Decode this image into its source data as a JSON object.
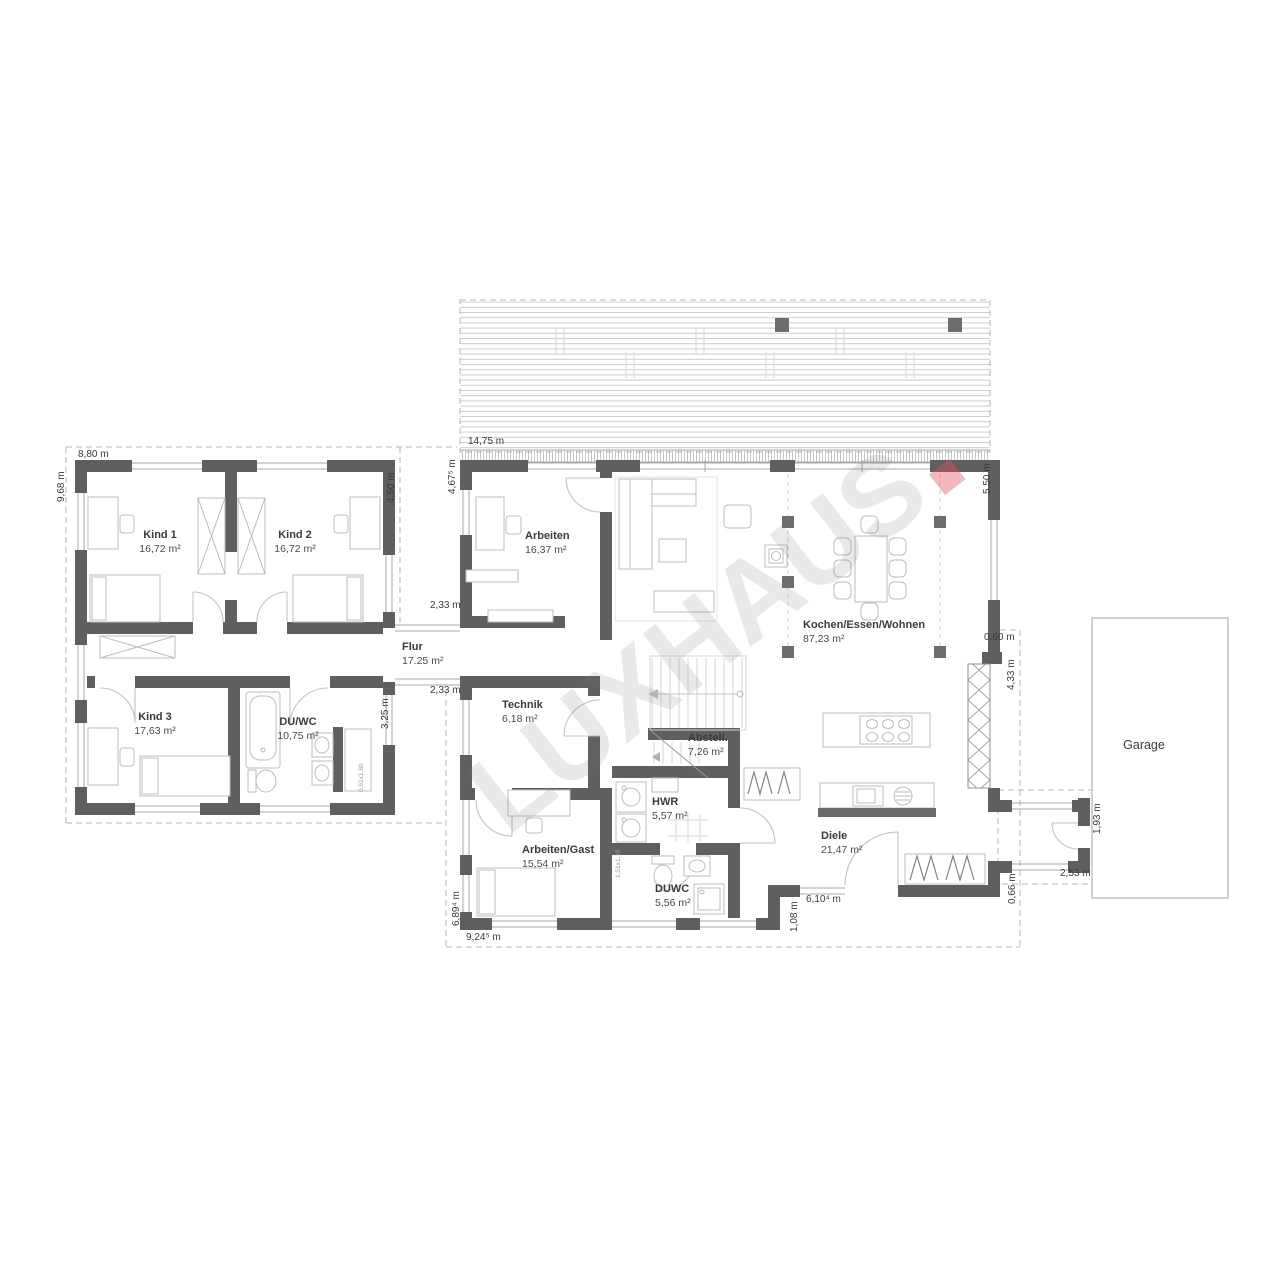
{
  "watermark": {
    "text": "LUXHAUS"
  },
  "colors": {
    "wall": "#5f5f5f",
    "watermark_gray": "#787878",
    "watermark_dot": "#e0505a"
  },
  "rooms": [
    {
      "name": "Kind 1",
      "area": "16,72 m²"
    },
    {
      "name": "Kind 2",
      "area": "16,72 m²"
    },
    {
      "name": "Kind 3",
      "area": "17,63 m²"
    },
    {
      "name": "DU/WC",
      "area": "10,75 m²"
    },
    {
      "name": "Flur",
      "area": "17.25 m²"
    },
    {
      "name": "Arbeiten",
      "area": "16,37 m²"
    },
    {
      "name": "Technik",
      "area": "6,18 m²"
    },
    {
      "name": "Kochen/Essen/Wohnen",
      "area": "87,23 m²"
    },
    {
      "name": "Abstell.",
      "area": "7,26 m²"
    },
    {
      "name": "HWR",
      "area": "5,57 m²"
    },
    {
      "name": "Arbeiten/Gast",
      "area": "15,54 m²"
    },
    {
      "name": "DUWC",
      "area": "5,56 m²"
    },
    {
      "name": "Diele",
      "area": "21,47 m²"
    },
    {
      "name": "Garage",
      "area": ""
    }
  ],
  "dims": [
    {
      "text": "8,80 m"
    },
    {
      "text": "9,68 m"
    },
    {
      "text": "4,50 m"
    },
    {
      "text": "14,75 m"
    },
    {
      "text": "4,67⁵ m"
    },
    {
      "text": "5,50 m"
    },
    {
      "text": "2,33 m"
    },
    {
      "text": "2,33 m"
    },
    {
      "text": "3,25 m"
    },
    {
      "text": "0,60 m"
    },
    {
      "text": "4,33 m"
    },
    {
      "text": "1,93 m"
    },
    {
      "text": "2,53 m"
    },
    {
      "text": "0,66 m"
    },
    {
      "text": "6,10⁴ m"
    },
    {
      "text": "1,08 m"
    },
    {
      "text": "6,89⁴ m"
    },
    {
      "text": "9,24⁵ m"
    }
  ],
  "small_labels": [
    {
      "text": "0,51x1,80"
    },
    {
      "text": "1,51x1,18"
    }
  ]
}
